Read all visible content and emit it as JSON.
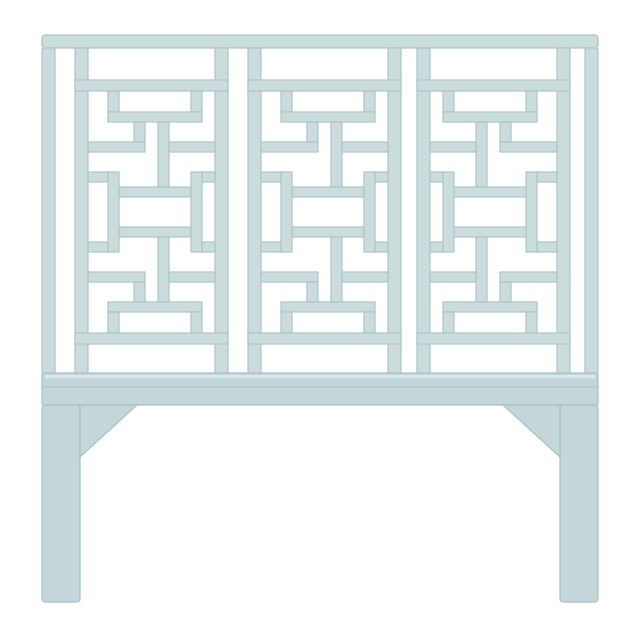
{
  "page": {
    "background": "#ffffff",
    "description": "Product photo of a pale seafoam blue chinoiserie fretwork headboard centered on a plain white background"
  },
  "colors": {
    "background": "#ffffff",
    "lattice_fill": "#cbdcdd",
    "lattice_stroke": "#abc5c8",
    "base_fill": "#c3d6d9",
    "base_stroke": "#a7c1c5",
    "rail_highlight": "#dfeaeb",
    "rail_seam": "#a2bdc2"
  },
  "headboard": {
    "kind": "fretwork-headboard",
    "style": "chinoiserie-lattice",
    "panel_count": 3,
    "panels": [
      {
        "id": "left",
        "orientation": "standard"
      },
      {
        "id": "center",
        "orientation": "standard"
      },
      {
        "id": "right",
        "orientation": "mirrored"
      }
    ],
    "leg_count": 2
  }
}
